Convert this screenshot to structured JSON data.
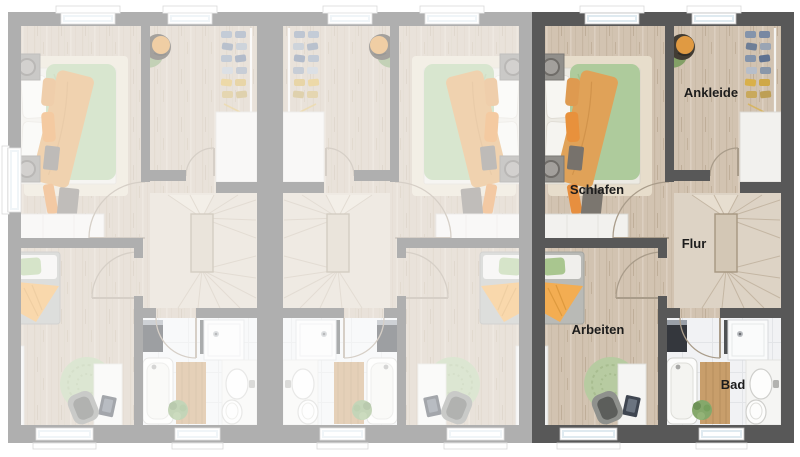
{
  "meta": {
    "description": "Top-down floor plan rendering of three adjacent terraced-house units (upper floor); right unit highlighted, left and middle units faded, middle unit mirrored",
    "language": "de"
  },
  "floorplan": {
    "units": [
      {
        "id": "unit-left",
        "state": "faded",
        "mirrored": false,
        "labels_visible": false
      },
      {
        "id": "unit-middle",
        "state": "faded",
        "mirrored": true,
        "labels_visible": false
      },
      {
        "id": "unit-right",
        "state": "highlighted",
        "mirrored": false,
        "labels_visible": true
      }
    ],
    "rooms": {
      "schlafen": "Schlafen",
      "ankleide": "Ankleide",
      "flur": "Flur",
      "arbeiten": "Arbeiten",
      "bad": "Bad"
    }
  },
  "colors": {
    "wall_dark": "#585858",
    "floor_wood": "#d2c3b1",
    "bath_tile": "#f1f2f4",
    "stairs": "#ddd3c5",
    "duvet_green": "#aecb9c",
    "blanket_orange": "#e0a258",
    "rug_green": "#b7cba1",
    "label_text": "#1c1c1c",
    "fade_overlay": "rgba(255,255,255,0.52)"
  }
}
